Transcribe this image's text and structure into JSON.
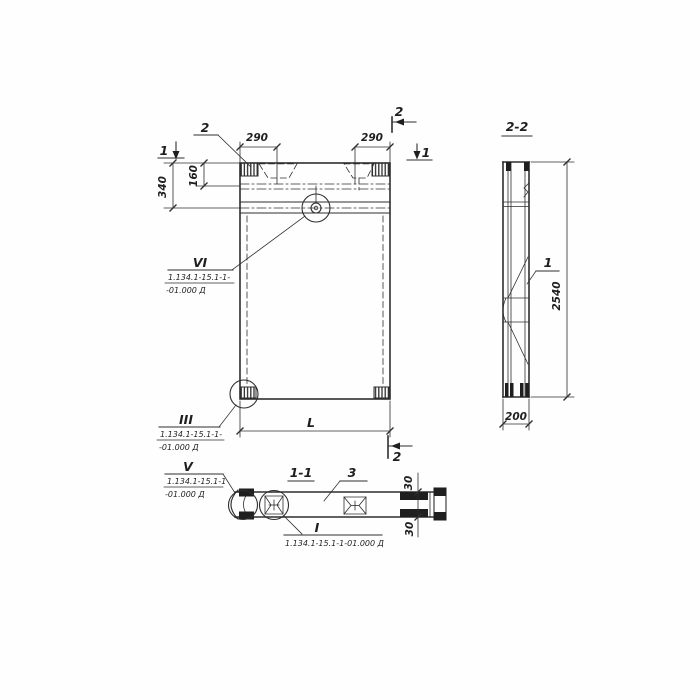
{
  "colors": {
    "ink": "#2e2e2e",
    "paper": "#fefefe"
  },
  "front_view": {
    "dims": {
      "top_left": "290",
      "top_right": "290",
      "edge_offset": "160",
      "top_band": "340",
      "length": "L"
    },
    "markers": {
      "cut1_left": "1",
      "cut1_right": "1",
      "cut2_top": "2",
      "cut2_bottom": "2",
      "detail_2": "2"
    },
    "callouts": {
      "vi": {
        "label": "VI",
        "ref1": "1.134.1-15.1-1-",
        "ref2": "-01.000 Д"
      },
      "iii": {
        "label": "III",
        "ref1": "1.134.1-15.1-1-",
        "ref2": "-01.000 Д"
      }
    }
  },
  "side_view": {
    "title": "2-2",
    "part": "1",
    "dims": {
      "height": "2540",
      "width": "200"
    }
  },
  "section_view": {
    "title": "1-1",
    "part": "3",
    "dims": {
      "top": "30",
      "bottom": "30"
    },
    "callouts": {
      "v": {
        "label": "V",
        "ref1": "1.134.1-15.1-1",
        "ref2": "-01.000 Д"
      },
      "i": {
        "label": "I",
        "ref": "1.134.1-15.1-1-01.000 Д"
      }
    }
  }
}
